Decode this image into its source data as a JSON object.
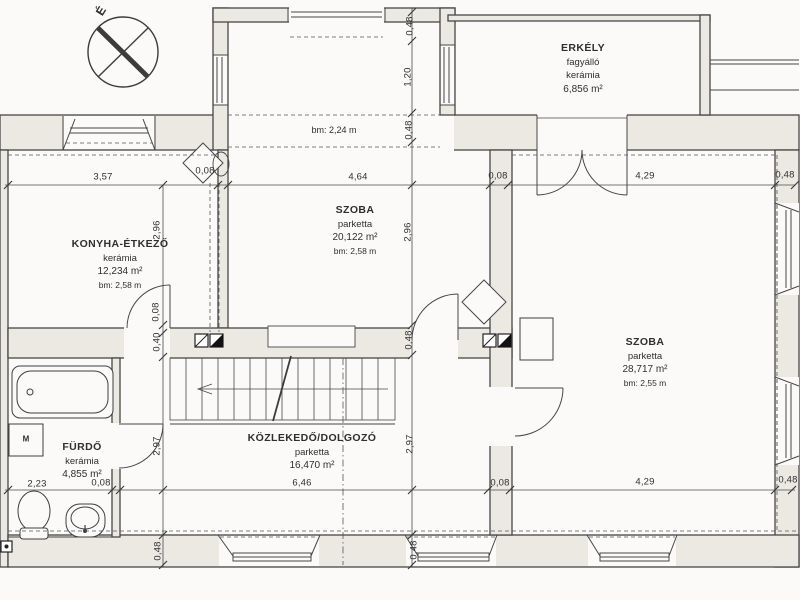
{
  "plan": {
    "type": "floor-plan",
    "language": "hu"
  },
  "north": {
    "label": "É"
  },
  "rooms": {
    "balcony": {
      "name": "ERKÉLY",
      "note": "fagyálló",
      "floor": "kerámia",
      "area": "6,856 m²"
    },
    "kitchen": {
      "name": "KONYHA-ÉTKEZŐ",
      "floor": "kerámia",
      "area": "12,234 m²",
      "height": "bm: 2,58 m"
    },
    "room_middle": {
      "name": "SZOBA",
      "floor": "parketta",
      "area": "20,122 m²",
      "height": "bm: 2,58 m"
    },
    "room_right": {
      "name": "SZOBA",
      "floor": "parketta",
      "area": "28,717 m²",
      "height": "bm: 2,55 m"
    },
    "bathroom": {
      "name": "FÜRDŐ",
      "floor": "kerámia",
      "area": "4,855 m²"
    },
    "hall": {
      "name": "KÖZLEKEDŐ/DOLGOZÓ",
      "floor": "parketta",
      "area": "16,470 m²"
    },
    "bay": {
      "height": "bm: 2,24 m"
    }
  },
  "fixtures": {
    "washing_machine_label": "M"
  },
  "dimensions": [
    "3,57",
    "0,08",
    "4,64",
    "0,08",
    "4,29",
    "0,48",
    "0,48",
    "1,20",
    "0,48",
    "2,96",
    "0,48",
    "2,97",
    "0,48",
    "2,96",
    "0,08",
    "0,40",
    "2,97",
    "0,48",
    "2,23",
    "0,08",
    "6,46",
    "0,08",
    "4,29",
    "0,48"
  ],
  "colors": {
    "paper": "#fbfaf8",
    "line": "#474747",
    "wall_fill": "#ece9e3",
    "flue_fill": "#111111"
  }
}
